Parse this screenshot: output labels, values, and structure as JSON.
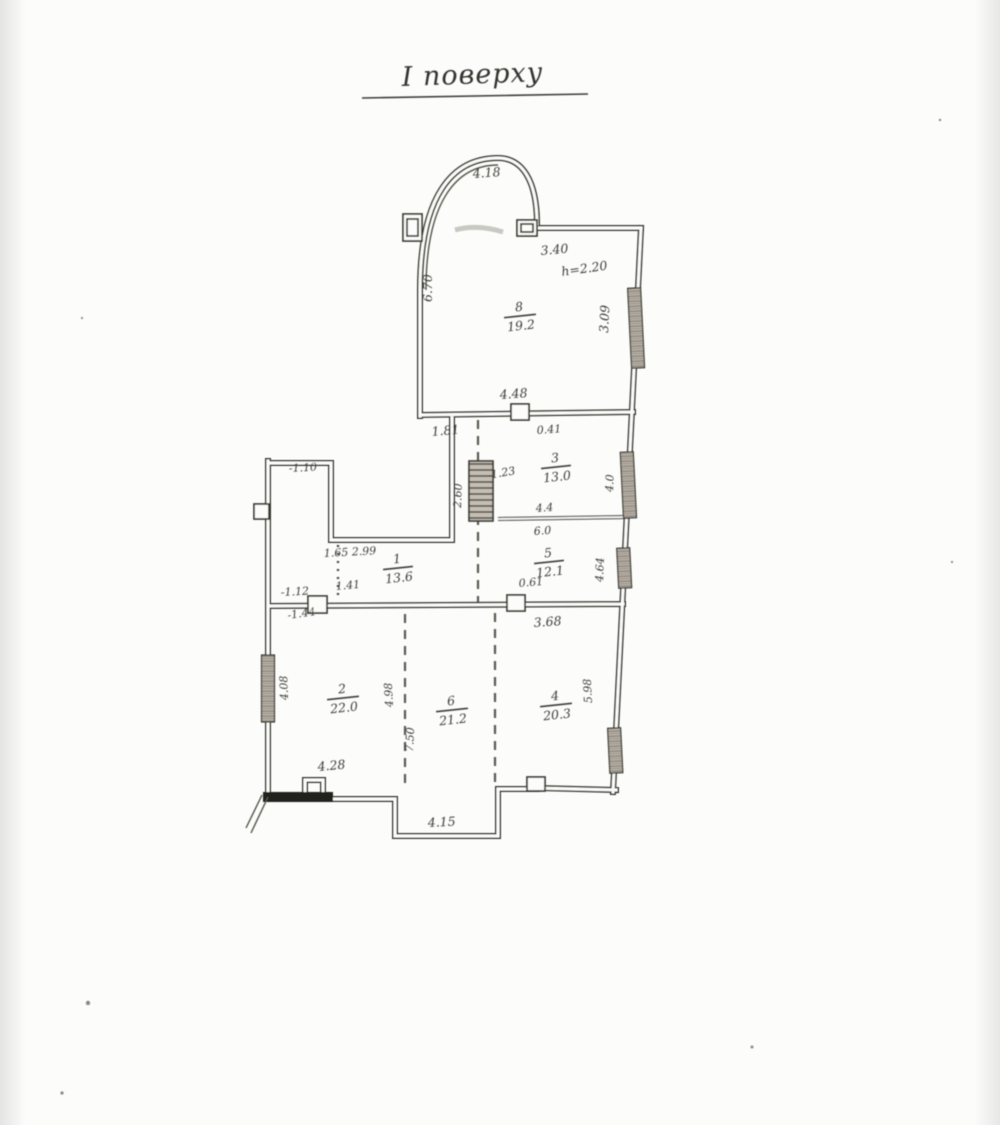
{
  "scan": {
    "title": "І поверху",
    "rooms": [
      {
        "number": "8",
        "area": "19.2"
      },
      {
        "number": "3",
        "area": "13.0"
      },
      {
        "number": "5",
        "area": "12.1"
      },
      {
        "number": "1",
        "area": "13.6"
      },
      {
        "number": "2",
        "area": "22.0"
      },
      {
        "number": "6",
        "area": "21.2"
      },
      {
        "number": "4",
        "area": "20.3"
      }
    ],
    "dims": {
      "arc_width": "4.18",
      "top_entry_width": "3.40",
      "height_note": "h=2.20",
      "left_wall_top_room": "6.70",
      "window_top_right": "3.09",
      "top_room_width": "4.48",
      "opening_left": "1.81",
      "opening_right": "0.41",
      "window_room3": "4.0",
      "room3_width_above": "4.4",
      "room3_width_below": "6.0",
      "window_room5": "4.64",
      "room5_door": "0.61",
      "hall_width": "3.68",
      "stair_width": "2.60",
      "stair_level": "-1.23",
      "notch_level": "-1.10",
      "stair_size": "1.65 2.99",
      "door_left_width": "1.41",
      "door_left_level": "-1.12",
      "left_mark": "-1.44",
      "window_left": "4.08",
      "span_left": "4.98",
      "span_right": "7.50",
      "window_bottom_right": "5.98",
      "ledge_width": "4.28",
      "porch_width": "4.15"
    }
  }
}
